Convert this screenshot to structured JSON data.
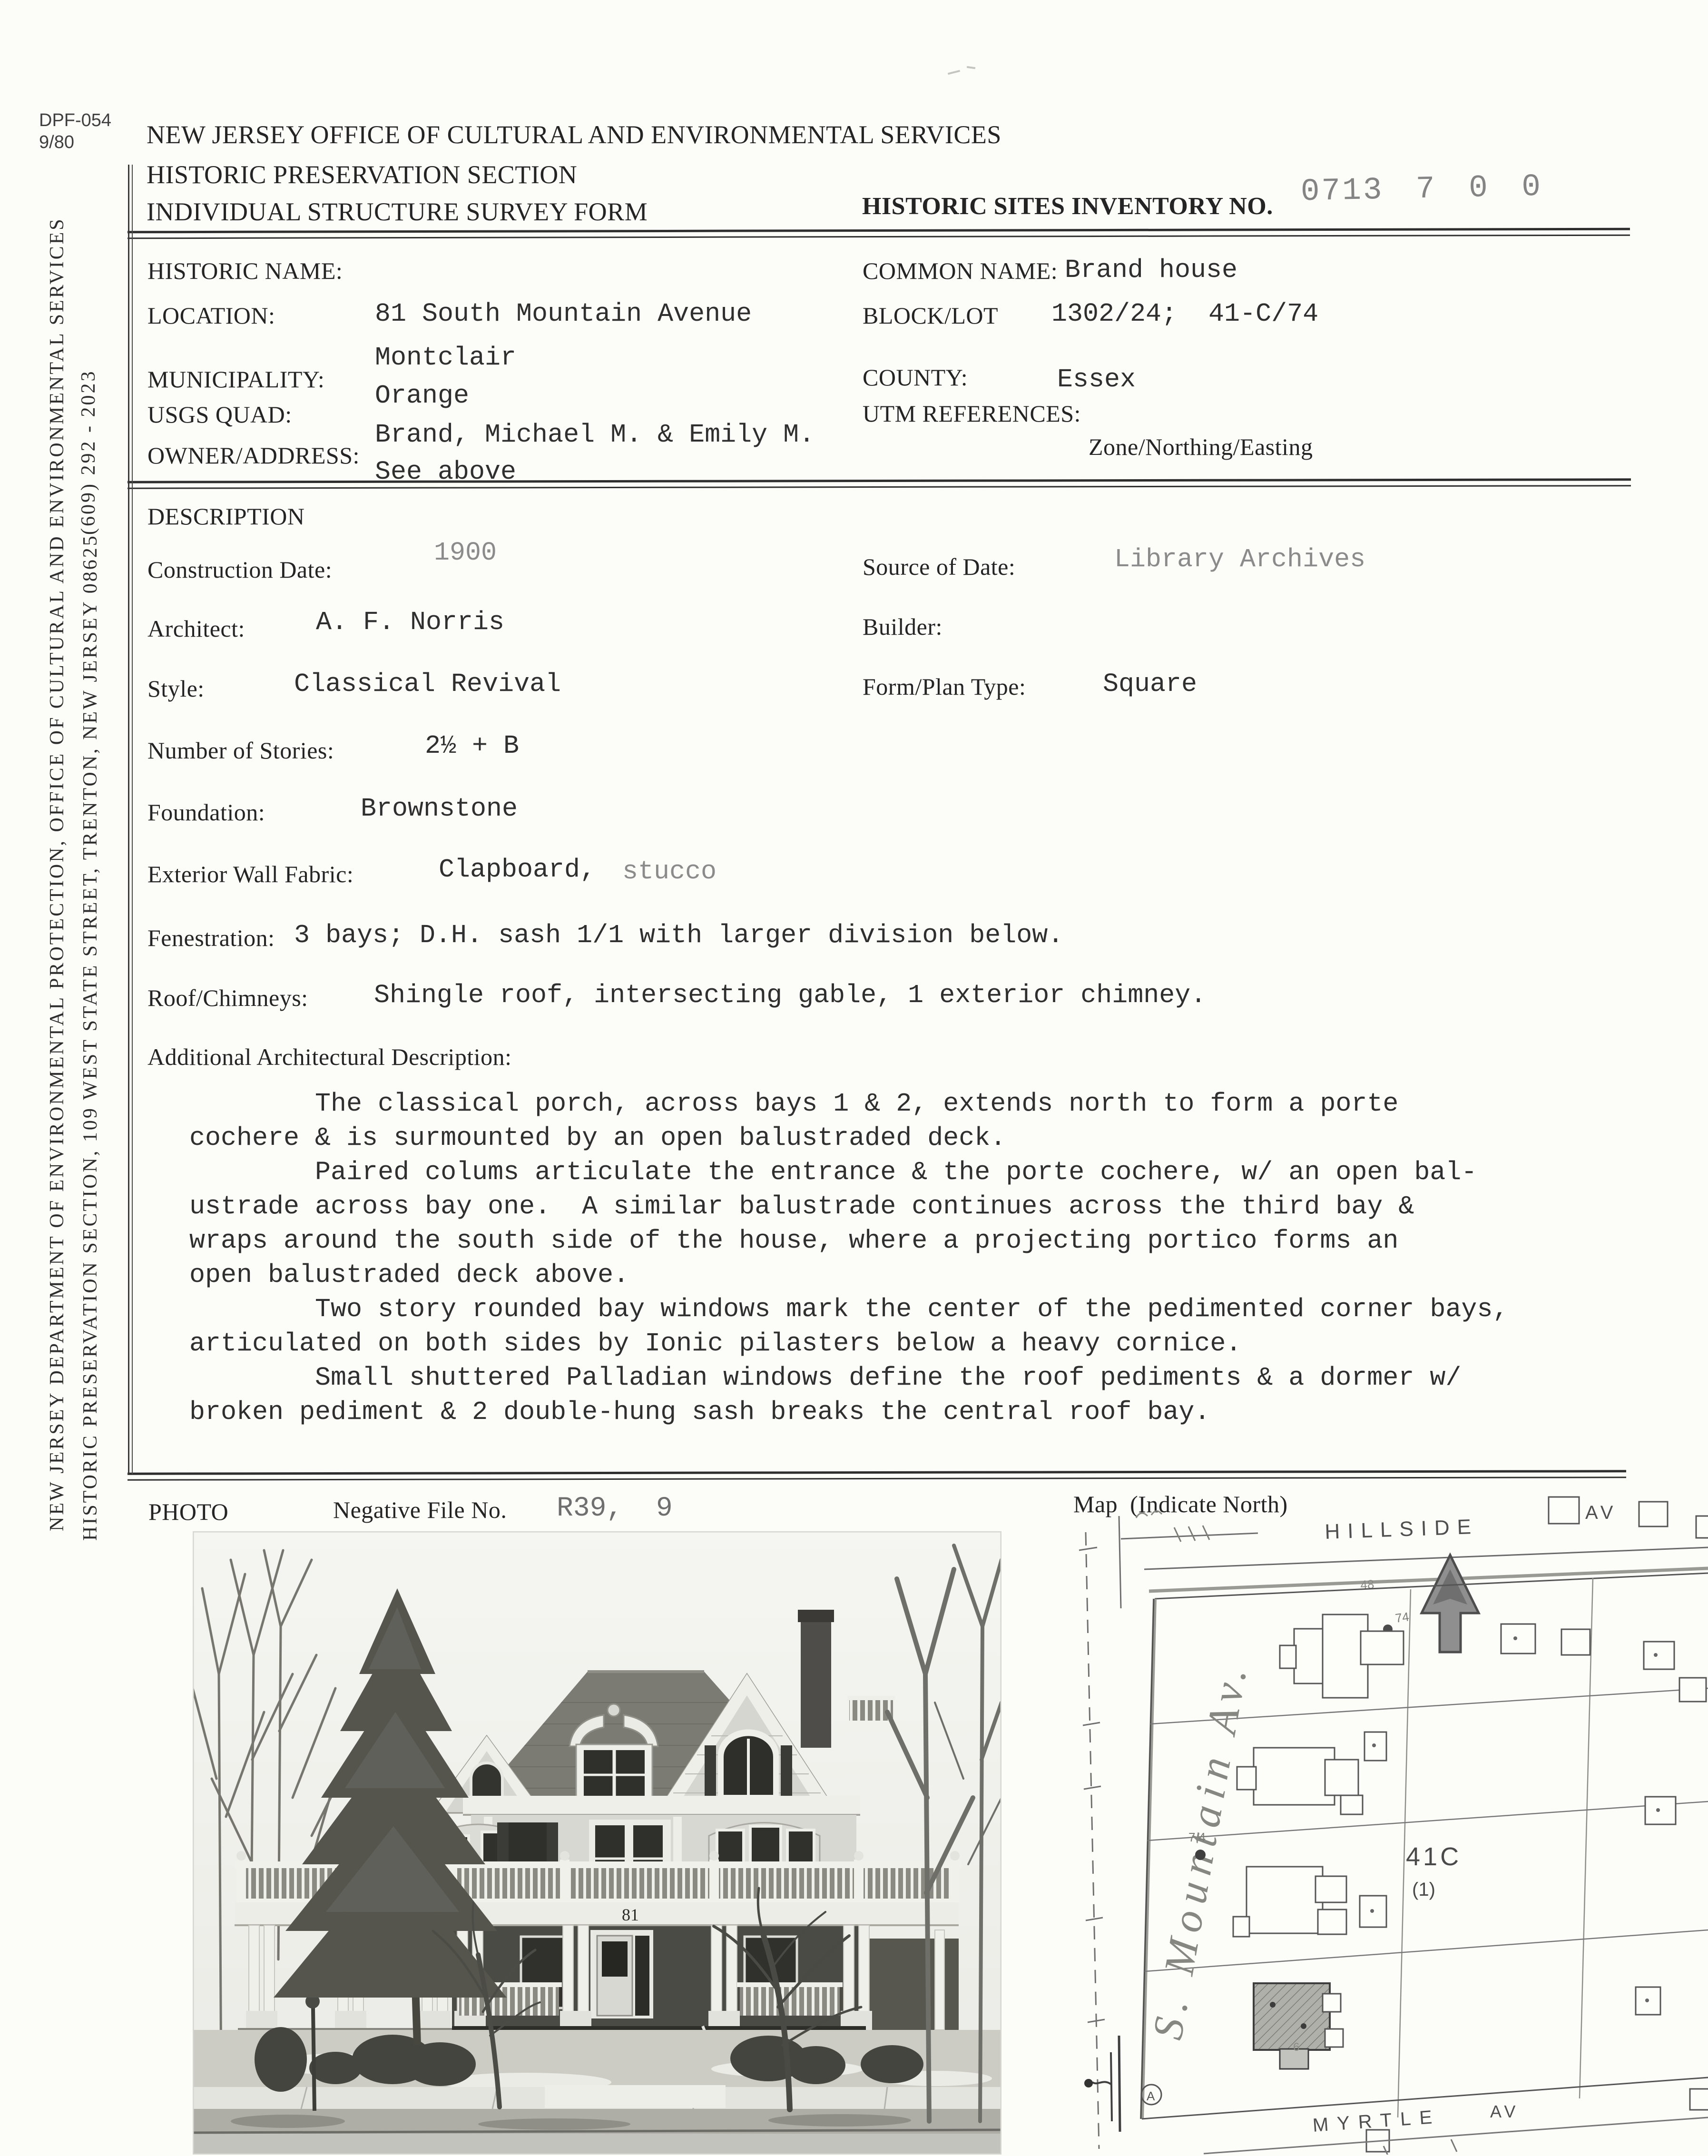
{
  "header": {
    "form_number": "DPF-054",
    "form_revision": "9/80",
    "line1": "NEW JERSEY OFFICE OF CULTURAL AND ENVIRONMENTAL SERVICES",
    "line2": "HISTORIC PRESERVATION SECTION",
    "line3": "INDIVIDUAL STRUCTURE SURVEY FORM",
    "inventory_label": "HISTORIC SITES INVENTORY NO.",
    "inventory_number": "0713 7 0 0"
  },
  "sidebar": {
    "outer": "NEW JERSEY DEPARTMENT OF ENVIRONMENTAL PROTECTION, OFFICE OF CULTURAL AND ENVIRONMENTAL SERVICES",
    "inner": "HISTORIC PRESERVATION SECTION, 109 WEST STATE STREET, TRENTON, NEW JERSEY 08625",
    "phone": "(609) 292 - 2023"
  },
  "identification": {
    "historic_name_label": "HISTORIC NAME:",
    "historic_name": "",
    "location_label": "LOCATION:",
    "location": "81 South Mountain Avenue",
    "municipality_label": "MUNICIPALITY:",
    "municipality": "Montclair",
    "usgs_quad_label": "USGS QUAD:",
    "usgs_quad": "Orange",
    "owner_label": "OWNER/ADDRESS:",
    "owner_line1": "Brand, Michael M. & Emily M.",
    "owner_line2": "See above",
    "common_name_label": "COMMON NAME:",
    "common_name": "Brand house",
    "block_lot_label": "BLOCK/LOT",
    "block_lot": "1302/24;  41-C/74",
    "county_label": "COUNTY:",
    "county": "Essex",
    "utm_label": "UTM REFERENCES:",
    "utm_sub_label": "Zone/Northing/Easting"
  },
  "description": {
    "section_title": "DESCRIPTION",
    "construction_date_label": "Construction Date:",
    "construction_date": "1900",
    "source_label": "Source of Date:",
    "source": "Library Archives",
    "architect_label": "Architect:",
    "architect": "A. F. Norris",
    "builder_label": "Builder:",
    "builder": "",
    "style_label": "Style:",
    "style": "Classical Revival",
    "form_plan_label": "Form/Plan Type:",
    "form_plan": "Square",
    "stories_label": "Number of Stories:",
    "stories": "2½ + B",
    "foundation_label": "Foundation:",
    "foundation": "Brownstone",
    "wall_label": "Exterior Wall Fabric:",
    "wall_value": "Clapboard,",
    "wall_value_gray": "stucco",
    "fenestration_label": "Fenestration:",
    "fenestration": "3 bays; D.H. sash 1/1 with larger division below.",
    "roof_label": "Roof/Chimneys:",
    "roof": "Shingle roof, intersecting gable, 1 exterior chimney.",
    "additional_label": "Additional Architectural Description:",
    "additional_lines": [
      "        The classical porch, across bays 1 & 2, extends north to form a porte",
      "cochere & is surmounted by an open balustraded deck.",
      "        Paired colums articulate the entrance & the porte cochere, w/ an open bal-",
      "ustrade across bay one.  A similar balustrade continues across the third bay &",
      "wraps around the south side of the house, where a projecting portico forms an",
      "open balustraded deck above.",
      "        Two story rounded bay windows mark the center of the pedimented corner bays,",
      "articulated on both sides by Ionic pilasters below a heavy cornice.",
      "        Small shuttered Palladian windows define the roof pediments & a dormer w/",
      "broken pediment & 2 double-hung sash breaks the central roof bay."
    ]
  },
  "photo_section": {
    "photo_label": "PHOTO",
    "negative_label": "Negative File No.",
    "negative_number": "R39,  9",
    "map_label": "Map  (Indicate North)",
    "house_number": "81"
  },
  "map": {
    "street_top": "HILLSIDE",
    "street_top_av": "AV",
    "street_left": "S. Mountain Av.",
    "street_bottom": "MYRTLE",
    "street_bottom_av": "AV",
    "block_label": "41C",
    "lot_label": "(1)",
    "annotation_48": "48",
    "annotation_74": "74",
    "annotation_7h": "7 4",
    "annotation_6": "6",
    "corner_marker": "A"
  },
  "colors": {
    "ink": "#262626",
    "typewriter_ink": "#2f2f2f",
    "stamp_gray": "#848484",
    "pencil_gray": "#6d6d6d"
  }
}
